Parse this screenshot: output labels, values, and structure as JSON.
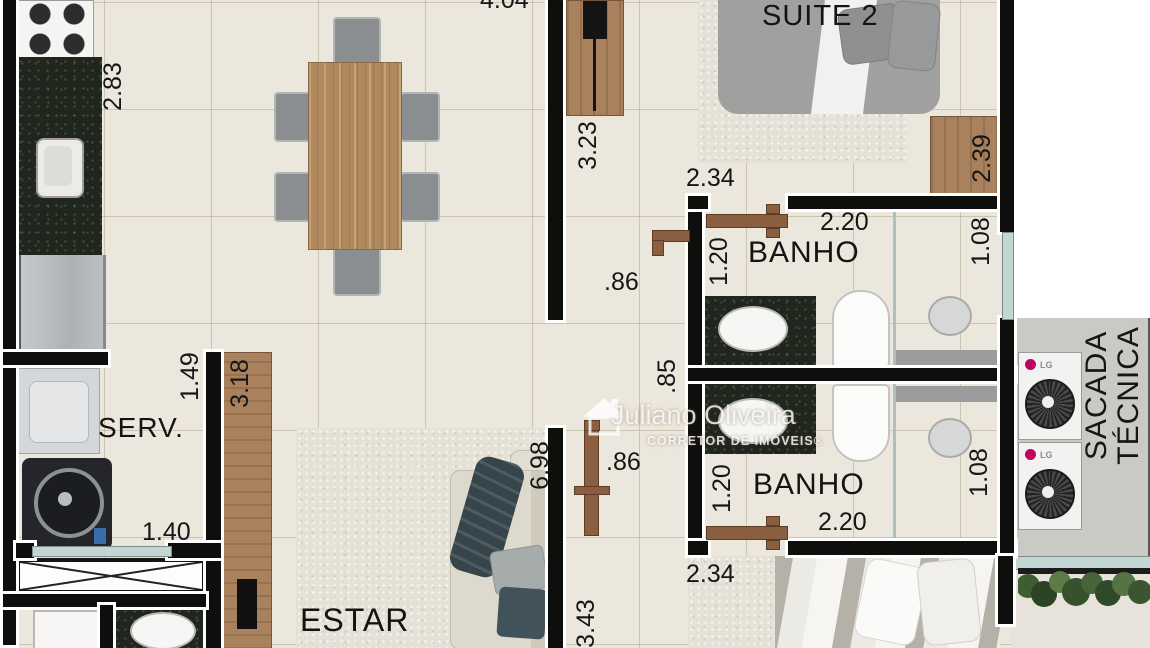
{
  "plan": {
    "watermark": {
      "name": "Juliano Oliveira",
      "subtitle": "CORRETOR DE IMÓVEIS®"
    },
    "rooms": {
      "suite2": "SUITE 2",
      "banho_top": "BANHO",
      "banho_bottom": "BANHO",
      "serv": "SERV.",
      "estar": "ESTAR",
      "sacada_line1": "SACADA",
      "sacada_line2": "TÉCNICA"
    },
    "dims": {
      "top_width": "4.04",
      "kitchen_depth": "2.83",
      "closet_len": "3.23",
      "suite2_width": "2.34",
      "dresser_len": "2.39",
      "banho_top_width": "2.20",
      "banho_top_left": "1.20",
      "banho_top_right": "1.08",
      "door_top": ".86",
      "hall_mid": ".85",
      "door_bottom": ".86",
      "banho_bottom_left": "1.20",
      "banho_bottom_width": "2.20",
      "banho_bottom_right": "1.08",
      "suite1_width": "2.34",
      "serv_depth": "1.49",
      "rack_len": "3.18",
      "serv_width": "1.40",
      "living_len": "6.98",
      "living_width": "3.43"
    },
    "appliances": {
      "ac_brand": "LG"
    },
    "colors": {
      "wall": "#0e0e0d",
      "floor": "#ece7dd",
      "granite": "#20251d",
      "wood": "#a9825d",
      "door": "#8a5f3f",
      "glass": "#c2d6d3",
      "sacada_floor": "#c9cac5",
      "lg_accent": "#c50063"
    }
  }
}
